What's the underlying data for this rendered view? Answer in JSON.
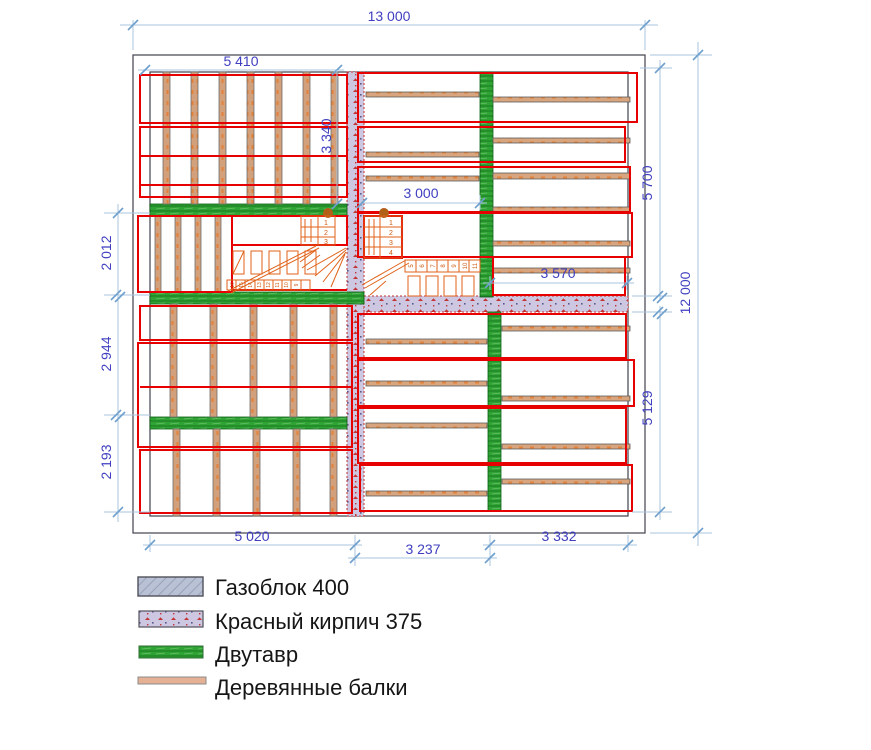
{
  "dimensions": {
    "overall_width": "13 000",
    "overall_height": "12 000",
    "left_room_width": "5 410",
    "left_room_height": "3 340",
    "right_room_width": "3 000",
    "right_room_lower_width": "3 570",
    "right_upper_height": "5 700",
    "right_lower_height": "5 129",
    "left_upper_height": "2 012",
    "left_middle_height": "2 944",
    "left_lower_height": "2 193",
    "bottom_left_width": "5 020",
    "bottom_middle_width": "3 237",
    "bottom_right_width": "3 332"
  },
  "legend": {
    "items": [
      {
        "label": "Газоблок 400",
        "swatch": "gasblock"
      },
      {
        "label": "Красный кирпич 375",
        "swatch": "red-brick"
      },
      {
        "label": "Двутавр",
        "swatch": "i-beam"
      },
      {
        "label": "Деревянные балки",
        "swatch": "wood-beam"
      }
    ]
  },
  "stairs": {
    "left_flight_steps": [
      "1",
      "2",
      "3"
    ],
    "left_bottom_steps": [
      "16",
      "15",
      "14",
      "13",
      "12",
      "11",
      "10",
      "9"
    ],
    "right_flight_steps": [
      "1",
      "2",
      "3",
      "4"
    ],
    "right_row_steps": [
      "5",
      "6",
      "7",
      "8",
      "9",
      "10",
      "11"
    ]
  },
  "colors": {
    "gasblock_fill": "#b9c1d5",
    "brick_fill": "#cec7e1",
    "ibeam_green": "#2fa333",
    "wood_fill": "#d6a077",
    "outline_red": "#e60000",
    "dimension_blue": "#4040c0",
    "stair_orange": "#e0621a"
  }
}
